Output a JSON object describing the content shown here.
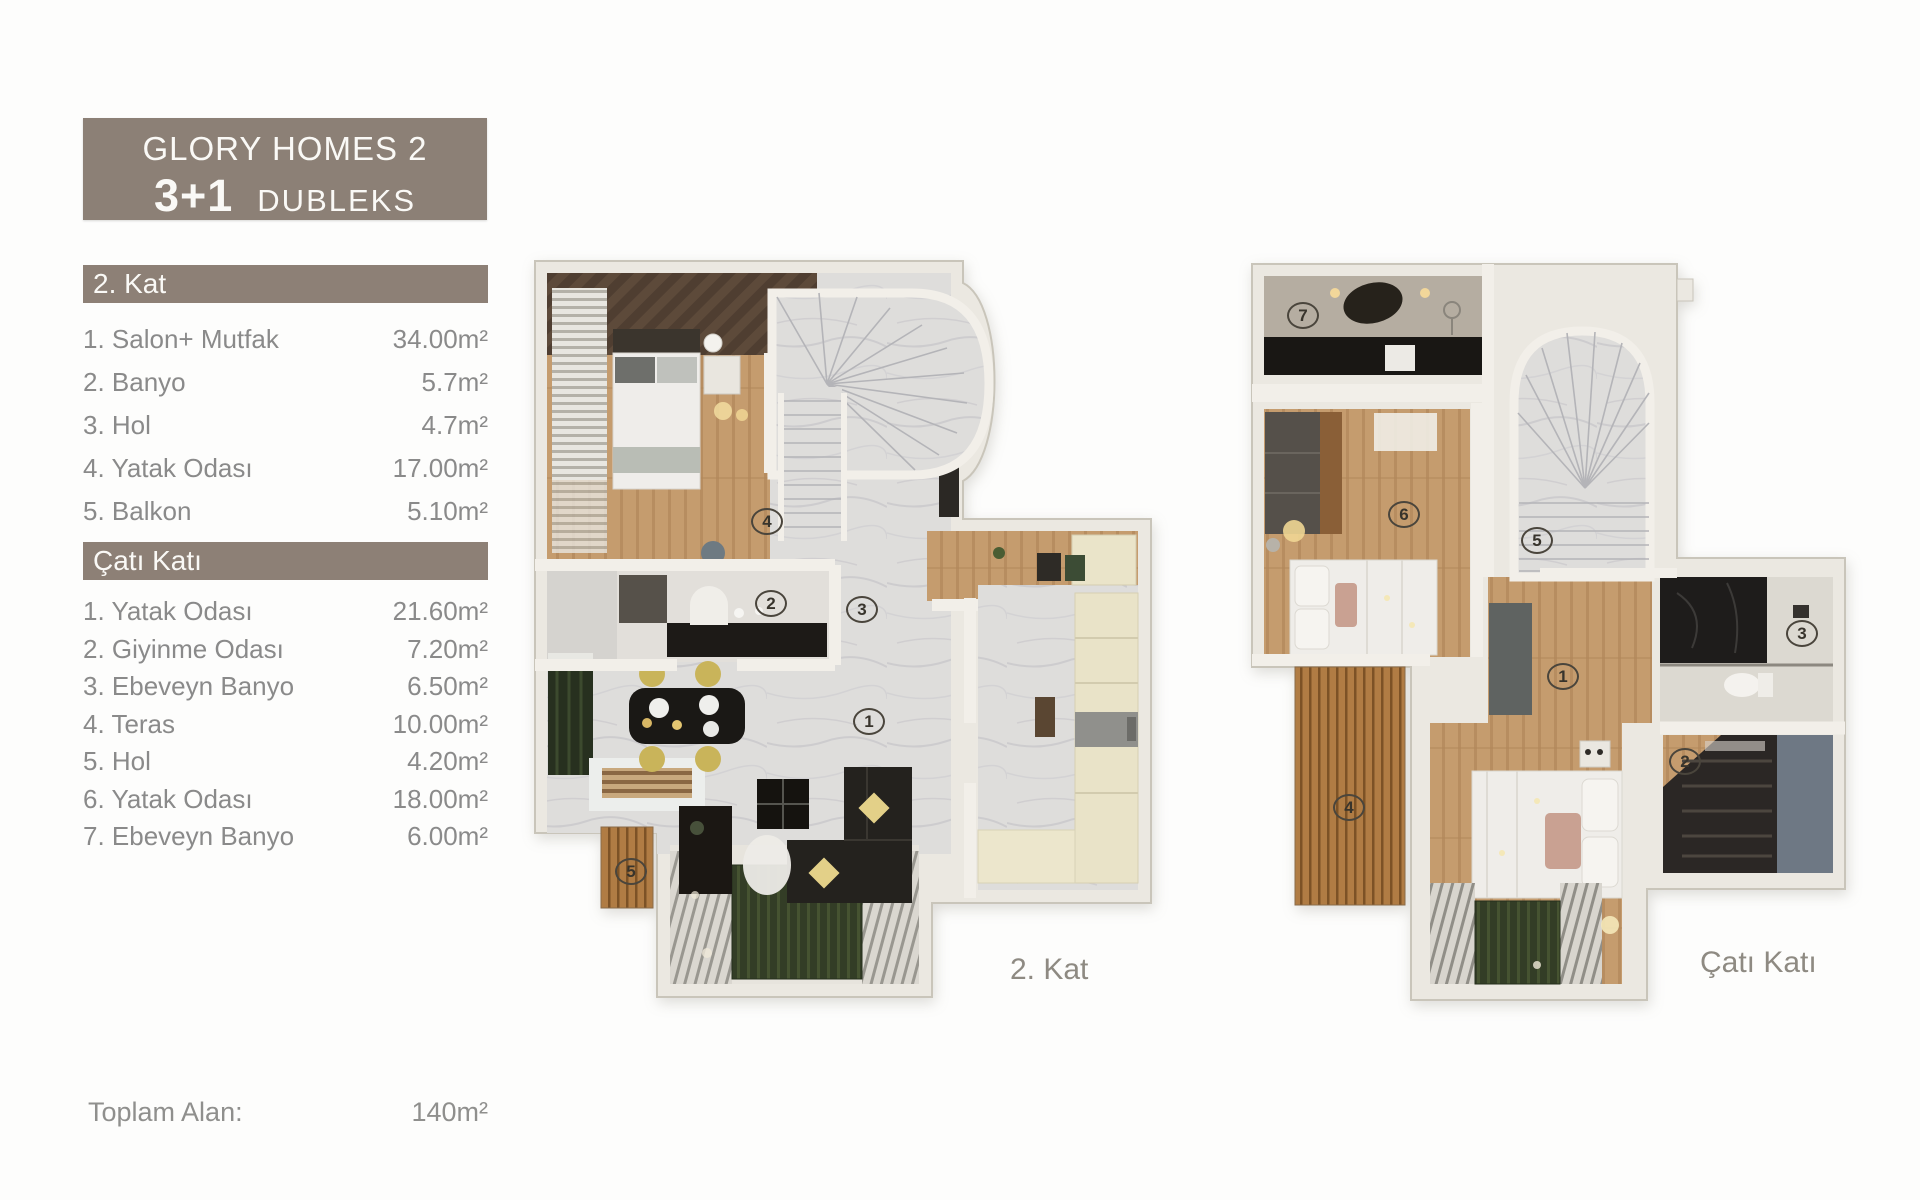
{
  "header": {
    "title": "GLORY HOMES 2",
    "subtitle_bold": "3+1",
    "subtitle": "DUBLEKS"
  },
  "sections": [
    {
      "title": "2. Kat",
      "items": [
        {
          "label": "1. Salon+ Mutfak",
          "area": "34.00m²"
        },
        {
          "label": "2. Banyo",
          "area": "5.7m²"
        },
        {
          "label": "3. Hol",
          "area": "4.7m²"
        },
        {
          "label": "4. Yatak Odası",
          "area": "17.00m²"
        },
        {
          "label": "5. Balkon",
          "area": "5.10m²"
        }
      ]
    },
    {
      "title": "Çatı Katı",
      "items": [
        {
          "label": "1. Yatak Odası",
          "area": "21.60m²"
        },
        {
          "label": "2. Giyinme Odası",
          "area": "7.20m²"
        },
        {
          "label": "3. Ebeveyn Banyo",
          "area": "6.50m²"
        },
        {
          "label": "4. Teras",
          "area": "10.00m²"
        },
        {
          "label": "5. Hol",
          "area": "4.20m²"
        },
        {
          "label": "6. Yatak Odası",
          "area": "18.00m²"
        },
        {
          "label": "7. Ebeveyn Banyo",
          "area": "6.00m²"
        }
      ]
    }
  ],
  "total": {
    "label": "Toplam Alan:",
    "value": "140m²"
  },
  "plans": [
    {
      "caption": "2. Kat",
      "markers": [
        {
          "n": "4"
        },
        {
          "n": "2"
        },
        {
          "n": "3"
        },
        {
          "n": "1"
        },
        {
          "n": "5"
        }
      ]
    },
    {
      "caption": "Çatı Katı",
      "markers": [
        {
          "n": "7"
        },
        {
          "n": "6"
        },
        {
          "n": "5"
        },
        {
          "n": "3"
        },
        {
          "n": "1"
        },
        {
          "n": "2"
        },
        {
          "n": "4"
        }
      ]
    }
  ],
  "colors": {
    "band": "#8d8076",
    "list_text": "#8a8a8a",
    "wall": "#ebe8e1",
    "wood": "#c59c6e",
    "marble": "#dedddb",
    "deck": "#b07c44",
    "dark_furniture": "#24221e",
    "cream": "#e9e3c8"
  }
}
